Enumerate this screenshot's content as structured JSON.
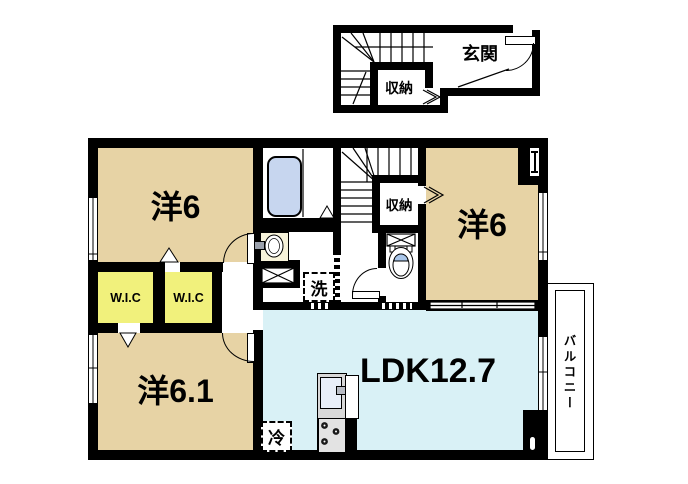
{
  "first_floor": {
    "entrance": "玄関",
    "storage": "収納"
  },
  "second_floor": {
    "bedroom_top_left": "洋6",
    "bedroom_right": "洋6",
    "bedroom_bottom_left": "洋6.1",
    "living": "LDK12.7",
    "wic_1": "W.I.C",
    "wic_2": "W.I.C",
    "storage": "収納",
    "laundry": "洗",
    "refrigerator": "冷",
    "balcony": "バルコニー"
  },
  "colors": {
    "wall": "#000000",
    "bedroom_tan": "#e7d3a5",
    "wic_yellow": "#f1f17c",
    "ldk_cyan": "#d9f1f6",
    "bathtub_blue": "#c7d6ef",
    "toilet_lid_blue": "#a9c6ea",
    "vanity_cream": "#f7f3da",
    "kitchen_gray": "#d8d8d8"
  }
}
